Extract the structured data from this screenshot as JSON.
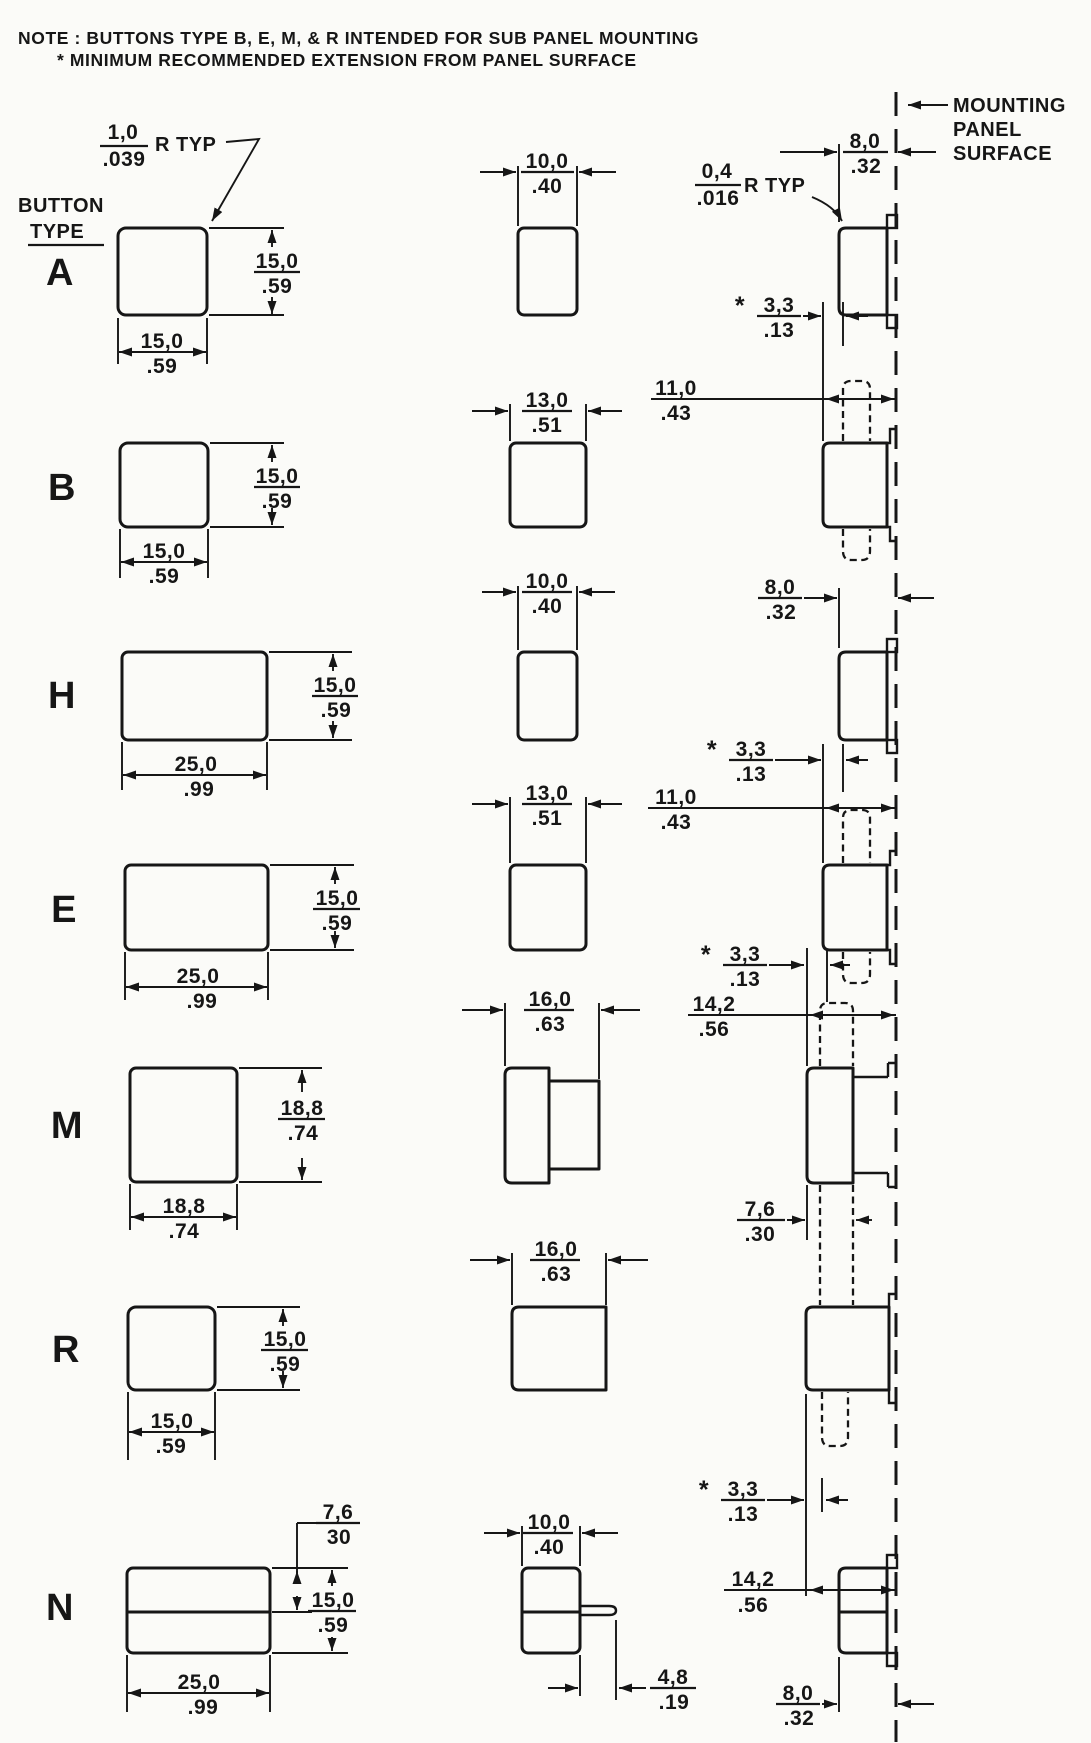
{
  "note": {
    "line1": "NOTE : BUTTONS TYPE B, E, M, & R INTENDED FOR SUB PANEL MOUNTING",
    "line2": "* MINIMUM RECOMMENDED EXTENSION FROM PANEL SURFACE"
  },
  "labels": {
    "button": "BUTTON",
    "type": "TYPE",
    "star": "*"
  },
  "panel": {
    "line1": "MOUNTING",
    "line2": "PANEL",
    "line3": "SURFACE"
  },
  "callouts": {
    "front_radius": {
      "mm": "1,0",
      "in": ".039",
      "label": "R TYP"
    },
    "side_radius": {
      "mm": "0,4",
      "in": ".016",
      "label": "R TYP"
    }
  },
  "rows": [
    {
      "type": "A",
      "front_w": {
        "mm": "15,0",
        "in": ".59"
      },
      "front_h": {
        "mm": "15,0",
        "in": ".59"
      },
      "side_w": {
        "mm": "10,0",
        "in": ".40"
      },
      "panel_ext": {
        "mm": "8,0",
        "in": ".32"
      }
    },
    {
      "type": "B",
      "front_w": {
        "mm": "15,0",
        "in": ".59"
      },
      "front_h": {
        "mm": "15,0",
        "in": ".59"
      },
      "side_w": {
        "mm": "13,0",
        "in": ".51"
      },
      "min_ext": {
        "mm": "3,3",
        "in": ".13"
      },
      "body_len": {
        "mm": "11,0",
        "in": ".43"
      }
    },
    {
      "type": "H",
      "front_w": {
        "mm": "25,0",
        "in": ".99"
      },
      "front_h": {
        "mm": "15,0",
        "in": ".59"
      },
      "side_w": {
        "mm": "10,0",
        "in": ".40"
      },
      "panel_ext": {
        "mm": "8,0",
        "in": ".32"
      }
    },
    {
      "type": "E",
      "front_w": {
        "mm": "25,0",
        "in": ".99"
      },
      "front_h": {
        "mm": "15,0",
        "in": ".59"
      },
      "side_w": {
        "mm": "13,0",
        "in": ".51"
      },
      "min_ext": {
        "mm": "3,3",
        "in": ".13"
      },
      "body_len": {
        "mm": "11,0",
        "in": ".43"
      }
    },
    {
      "type": "M",
      "front_w": {
        "mm": "18,8",
        "in": ".74"
      },
      "front_h": {
        "mm": "18,8",
        "in": ".74"
      },
      "side_w": {
        "mm": "16,0",
        "in": ".63"
      },
      "min_ext": {
        "mm": "3,3",
        "in": ".13"
      },
      "body_len": {
        "mm": "14,2",
        "in": ".56"
      },
      "plunger_w": {
        "mm": "7,6",
        "in": ".30"
      }
    },
    {
      "type": "R",
      "front_w": {
        "mm": "15,0",
        "in": ".59"
      },
      "front_h": {
        "mm": "15,0",
        "in": ".59"
      },
      "side_w": {
        "mm": "16,0",
        "in": ".63"
      },
      "min_ext": {
        "mm": "3,3",
        "in": ".13"
      },
      "body_len": {
        "mm": "14,2",
        "in": ".56"
      }
    },
    {
      "type": "N",
      "front_w": {
        "mm": "25,0",
        "in": ".99"
      },
      "front_h": {
        "mm": "15,0",
        "in": ".59"
      },
      "top_section_h": {
        "mm": "7,6",
        "in": "30"
      },
      "side_w": {
        "mm": "10,0",
        "in": ".40"
      },
      "pin_len": {
        "mm": "4,8",
        "in": ".19"
      },
      "panel_ext": {
        "mm": "8,0",
        "in": ".32"
      }
    }
  ]
}
